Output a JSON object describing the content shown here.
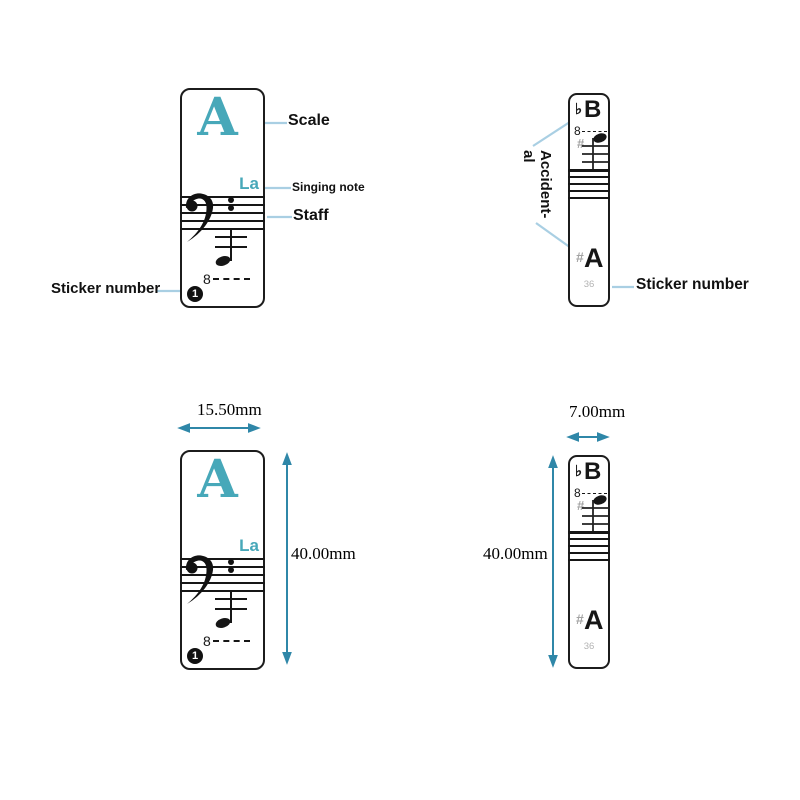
{
  "white_sticker": {
    "scale_letter": "A",
    "singing_note": "La",
    "octave": "8",
    "number": "1"
  },
  "black_sticker": {
    "flat_symbol": "♭",
    "flat_letter": "B",
    "octave": "8",
    "sharp_symbol": "#",
    "sharp_letter": "A",
    "number": "36"
  },
  "annotations": {
    "scale": "Scale",
    "singing_note": "Singing note",
    "staff": "Staff",
    "sticker_number_left": "Sticker number",
    "accidental_line1": "Accident-",
    "accidental_line2": "al",
    "sticker_number_right": "Sticker number"
  },
  "dimensions": {
    "white_width": "15.50mm",
    "white_height": "40.00mm",
    "black_width": "7.00mm",
    "black_height": "40.00mm"
  },
  "colors": {
    "accent_teal": "#47a8b9",
    "callout_line": "#a9cfe3",
    "dimension_arrow": "#2f87a8",
    "accidental_gray": "#a3a3a3",
    "number_gray": "#b3b3b3"
  }
}
